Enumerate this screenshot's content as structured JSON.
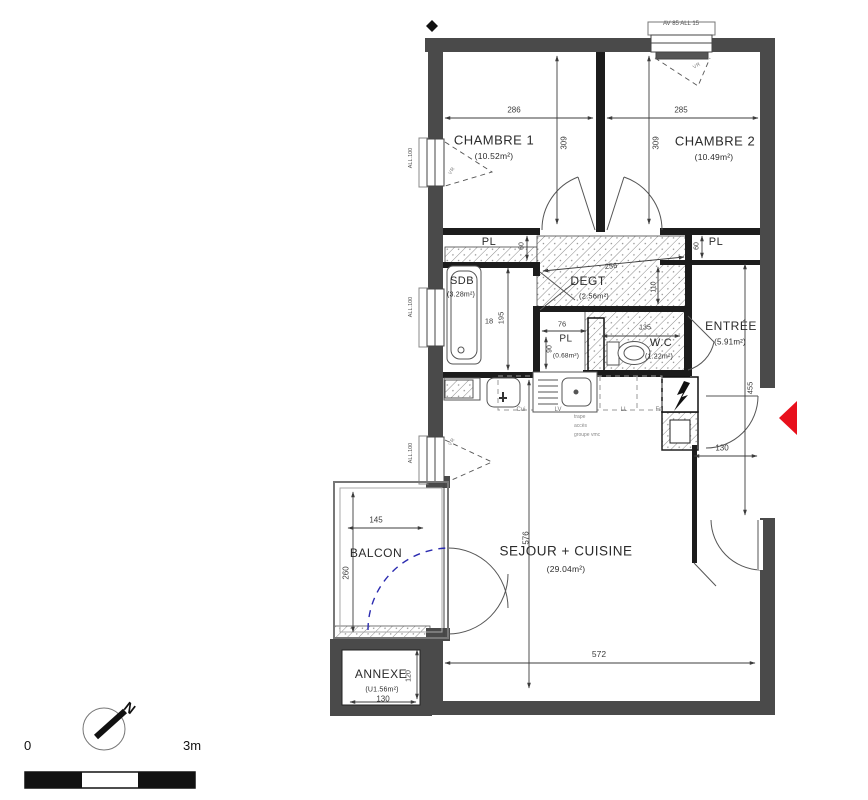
{
  "meta": {
    "top_note": "AV 85 ALL 15"
  },
  "rooms": {
    "chambre1": {
      "name": "CHAMBRE 1",
      "area": "(10.52m²)"
    },
    "chambre2": {
      "name": "CHAMBRE 2",
      "area": "(10.49m²)"
    },
    "sdb": {
      "name": "SDB",
      "area": "(3.28m²)"
    },
    "degt": {
      "name": "DEGT",
      "area": "(2.56m²)"
    },
    "pl_left": {
      "name": "PL"
    },
    "pl_right": {
      "name": "PL"
    },
    "pl_small": {
      "name": "PL",
      "area": "(0.68m²)"
    },
    "wc": {
      "name": "W.C",
      "area": "(1.22m²)"
    },
    "entree": {
      "name": "ENTRÉE",
      "area": "(5.91m²)"
    },
    "sejour": {
      "name": "SEJOUR + CUISINE",
      "area": "(29.04m²)"
    },
    "balcon": {
      "name": "BALCON"
    },
    "annexe": {
      "name": "ANNEXE",
      "area": "(U1.56m²)"
    }
  },
  "dims": {
    "chambre1_w": "286",
    "chambre2_w": "285",
    "chambre1_h": "309",
    "chambre2_h": "309",
    "degt_w": "256",
    "degt_h": "110",
    "pl_left_d": "60",
    "pl_right_d": "60",
    "sdb_18": "18",
    "sdb_h": "195",
    "pl_small_w": "76",
    "pl_small_h": "90",
    "wc_w": "135",
    "entree_h": "455",
    "entree_w": "130",
    "sejour_h": "576",
    "sejour_w": "572",
    "balcon_w": "145",
    "balcon_h": "260",
    "annexe_w": "130",
    "annexe_h": "120"
  },
  "appliances": {
    "cui": "Cui",
    "lv": "LV",
    "ll": "LL",
    "fri": "Fri",
    "trape": "trape",
    "acces": "accès",
    "groupe": "groupe vmc"
  },
  "windows": {
    "vr": "VR",
    "all1": "ALL.100",
    "all2": "ALL.100",
    "all3": "ALL.100"
  },
  "scale": {
    "zero": "0",
    "max": "3m"
  },
  "compass": {
    "north": "N"
  },
  "colors": {
    "wall": "#4a4a4a",
    "accent_red": "#e8101c",
    "balcony_blue": "#2b2bb0"
  }
}
